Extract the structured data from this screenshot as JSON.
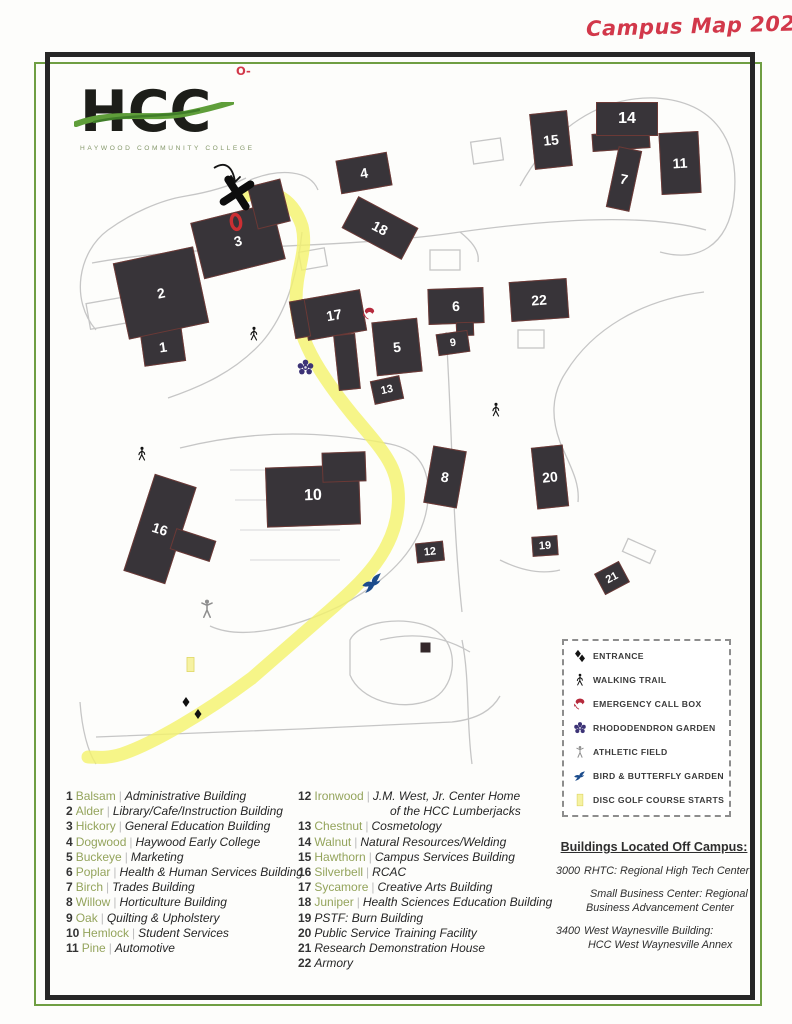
{
  "title": {
    "text": "Campus Map 2024"
  },
  "logo": {
    "acronym": "HCC",
    "subtitle": "HAYWOOD COMMUNITY COLLEGE"
  },
  "notes": {
    "top_bullet": "O-",
    "top_lines": [
      "Come up the ramp to the double",
      "exterior doors. Once you enter",
      "the building LSS is the",
      "first set of double",
      "doors to your",
      "right."
    ],
    "park_lines": [
      "Park",
      "here"
    ],
    "bottom_lines": [
      "* If you have any questions about",
      "how to get to LSS, please call us at",
      "(828) 627-4696"
    ]
  },
  "map": {
    "route_color": "#f4f36b",
    "buildings": [
      {
        "num": "1",
        "x": 142,
        "y": 330,
        "w": 42,
        "h": 34,
        "rot": -8
      },
      {
        "num": "2",
        "x": 120,
        "y": 254,
        "w": 82,
        "h": 78,
        "rot": -12
      },
      {
        "num": "3",
        "x": 196,
        "y": 212,
        "w": 84,
        "h": 58,
        "rot": -14
      },
      {
        "num": "",
        "x": 252,
        "y": 182,
        "w": 34,
        "h": 44,
        "rot": -14
      },
      {
        "num": "4",
        "x": 338,
        "y": 156,
        "w": 52,
        "h": 34,
        "rot": -10
      },
      {
        "num": "5",
        "x": 374,
        "y": 320,
        "w": 46,
        "h": 54,
        "rot": -6
      },
      {
        "num": "6",
        "x": 428,
        "y": 288,
        "w": 56,
        "h": 36,
        "rot": -2
      },
      {
        "num": "",
        "x": 456,
        "y": 322,
        "w": 18,
        "h": 14,
        "rot": -2
      },
      {
        "num": "",
        "x": 592,
        "y": 132,
        "w": 58,
        "h": 18,
        "rot": -4
      },
      {
        "num": "7",
        "x": 612,
        "y": 148,
        "w": 24,
        "h": 62,
        "rot": 12
      },
      {
        "num": "8",
        "x": 428,
        "y": 448,
        "w": 34,
        "h": 58,
        "rot": 10
      },
      {
        "num": "9",
        "x": 437,
        "y": 332,
        "w": 32,
        "h": 22,
        "rot": -8,
        "fs": 11
      },
      {
        "num": "10",
        "x": 266,
        "y": 466,
        "w": 94,
        "h": 60,
        "rot": -2,
        "fs": 16
      },
      {
        "num": "",
        "x": 322,
        "y": 452,
        "w": 44,
        "h": 30,
        "rot": -2
      },
      {
        "num": "11",
        "x": 660,
        "y": 132,
        "w": 40,
        "h": 62,
        "rot": -3
      },
      {
        "num": "12",
        "x": 416,
        "y": 542,
        "w": 28,
        "h": 20,
        "rot": -6,
        "fs": 11
      },
      {
        "num": "13",
        "x": 372,
        "y": 378,
        "w": 30,
        "h": 24,
        "rot": -12,
        "fs": 11
      },
      {
        "num": "14",
        "x": 596,
        "y": 102,
        "w": 62,
        "h": 34,
        "rot": 0,
        "fs": 16
      },
      {
        "num": "15",
        "x": 532,
        "y": 112,
        "w": 38,
        "h": 56,
        "rot": -6
      },
      {
        "num": "16",
        "x": 138,
        "y": 478,
        "w": 44,
        "h": 102,
        "rot": 18
      },
      {
        "num": "",
        "x": 172,
        "y": 534,
        "w": 42,
        "h": 22,
        "rot": 18
      },
      {
        "num": "17",
        "x": 304,
        "y": 294,
        "w": 60,
        "h": 42,
        "rot": -10
      },
      {
        "num": "",
        "x": 336,
        "y": 334,
        "w": 22,
        "h": 56,
        "rot": -6
      },
      {
        "num": "",
        "x": 292,
        "y": 300,
        "w": 16,
        "h": 38,
        "rot": -10
      },
      {
        "num": "18",
        "x": 346,
        "y": 210,
        "w": 68,
        "h": 36,
        "rot": 28
      },
      {
        "num": "19",
        "x": 532,
        "y": 536,
        "w": 26,
        "h": 20,
        "rot": -4,
        "fs": 11
      },
      {
        "num": "20",
        "x": 534,
        "y": 446,
        "w": 32,
        "h": 62,
        "rot": -6
      },
      {
        "num": "21",
        "x": 598,
        "y": 566,
        "w": 28,
        "h": 24,
        "rot": -28,
        "fs": 11
      },
      {
        "num": "22",
        "x": 510,
        "y": 280,
        "w": 58,
        "h": 40,
        "rot": -4
      }
    ],
    "road_labels": [
      {
        "t": "VOCATIONAL DR.",
        "x": 448,
        "y": 218,
        "rot": -8,
        "fs": 9,
        "ls": 1.2
      },
      {
        "t": "COLLEGE DR",
        "x": 253,
        "y": 318,
        "rot": -49,
        "fs": 9,
        "ls": 1
      },
      {
        "t": "SAWMILL DR.",
        "x": 432,
        "y": 592,
        "rot": -89,
        "fs": 9.5,
        "ls": 2
      },
      {
        "t": "RESEARCH HOUSE DR.",
        "x": 566,
        "y": 376,
        "rot": -32,
        "fs": 8,
        "ls": 1
      },
      {
        "t": "FREEDLANDER DR.",
        "x": 146,
        "y": 696,
        "rot": -28,
        "fs": 10,
        "ls": 1.2
      },
      {
        "t": "JONES COVE RD.",
        "x": 272,
        "y": 724,
        "rot": -1,
        "fs": 10,
        "ls": 1.2
      },
      {
        "t": "ARMORY DR.",
        "x": 452,
        "y": 760,
        "rot": -87,
        "fs": 9,
        "ls": 1.5
      },
      {
        "t": "HOSPITAL DR.",
        "x": 66,
        "y": 764,
        "rot": -72,
        "fs": 8.5,
        "ls": 0.8
      }
    ],
    "area_lines": [
      "MILLHOUSE",
      "&",
      "POND"
    ],
    "icons": [
      {
        "type": "x-mark",
        "x": 220,
        "y": 176,
        "s": 34,
        "rot": 12,
        "color": "#0d0d0d"
      },
      {
        "type": "red-oval",
        "x": 226,
        "y": 212,
        "s": 20,
        "rot": -10,
        "color": "#cc2f33"
      },
      {
        "type": "walking",
        "x": 246,
        "y": 326,
        "s": 16,
        "color": "#141414"
      },
      {
        "type": "walking",
        "x": 488,
        "y": 402,
        "s": 16,
        "color": "#141414"
      },
      {
        "type": "walking",
        "x": 134,
        "y": 446,
        "s": 16,
        "color": "#141414"
      },
      {
        "type": "athletic",
        "x": 196,
        "y": 598,
        "s": 22,
        "color": "#8f8f8f"
      },
      {
        "type": "callbox",
        "x": 362,
        "y": 306,
        "s": 15,
        "color": "#b52a3c"
      },
      {
        "type": "rhododendron",
        "x": 296,
        "y": 358,
        "s": 19,
        "color": "#3c3376"
      },
      {
        "type": "bird",
        "x": 360,
        "y": 570,
        "s": 26,
        "rot": -8,
        "color": "#1c4c8c"
      },
      {
        "type": "entrance-diamond",
        "x": 180,
        "y": 696,
        "s": 12,
        "color": "#101010"
      },
      {
        "type": "entrance-diamond",
        "x": 192,
        "y": 708,
        "s": 12,
        "color": "#101010"
      },
      {
        "type": "disc-golf",
        "x": 182,
        "y": 656,
        "s": 17
      },
      {
        "type": "millhouse",
        "x": 418,
        "y": 640,
        "s": 15,
        "color": "#33272a"
      }
    ]
  },
  "legend": {
    "items": [
      {
        "icon": "entrance",
        "label": "ENTRANCE",
        "color": "#141414"
      },
      {
        "icon": "walking",
        "label": "WALKING TRAIL",
        "color": "#141414"
      },
      {
        "icon": "callbox",
        "label": "EMERGENCY CALL BOX",
        "color": "#b52a3c"
      },
      {
        "icon": "rhododendron",
        "label": "RHODODENDRON GARDEN",
        "color": "#3c3376"
      },
      {
        "icon": "athletic",
        "label": "ATHLETIC FIELD",
        "color": "#8f8f8f"
      },
      {
        "icon": "bird",
        "label": "BIRD & BUTTERFLY GARDEN",
        "color": "#1c4c8c"
      },
      {
        "icon": "disc-golf",
        "label": "DISC GOLF COURSE STARTS",
        "color": "#e8e070"
      }
    ]
  },
  "list": {
    "left": [
      {
        "num": "1",
        "name": "Balsam",
        "sep": "|",
        "desc": "Administrative Building"
      },
      {
        "num": "2",
        "name": "Alder",
        "sep": "|",
        "desc": "Library/Cafe/Instruction Building"
      },
      {
        "num": "3",
        "name": "Hickory",
        "sep": "|",
        "desc": "General Education Building"
      },
      {
        "num": "4",
        "name": "Dogwood",
        "sep": "|",
        "desc": "Haywood Early College"
      },
      {
        "num": "5",
        "name": "Buckeye",
        "sep": "|",
        "desc": "Marketing"
      },
      {
        "num": "6",
        "name": "Poplar",
        "sep": "|",
        "desc": "Health & Human Services Building"
      },
      {
        "num": "7",
        "name": "Birch",
        "sep": "|",
        "desc": "Trades Building"
      },
      {
        "num": "8",
        "name": "Willow",
        "sep": "|",
        "desc": "Horticulture Building"
      },
      {
        "num": "9",
        "name": "Oak",
        "sep": "|",
        "desc": "Quilting & Upholstery"
      },
      {
        "num": "10",
        "name": "Hemlock",
        "sep": "|",
        "desc": "Student Services"
      },
      {
        "num": "11",
        "name": "Pine",
        "sep": "|",
        "desc": "Automotive"
      }
    ],
    "right": [
      {
        "num": "12",
        "name": "Ironwood",
        "sep": "|",
        "desc": "J.M. West, Jr. Center Home",
        "desc2": "of the HCC Lumberjacks"
      },
      {
        "num": "13",
        "name": "Chestnut",
        "sep": "|",
        "desc": "Cosmetology"
      },
      {
        "num": "14",
        "name": "Walnut",
        "sep": "|",
        "desc": "Natural Resources/Welding"
      },
      {
        "num": "15",
        "name": "Hawthorn",
        "sep": "|",
        "desc": "Campus Services Building"
      },
      {
        "num": "16",
        "name": "Silverbell",
        "sep": "|",
        "desc": "RCAC"
      },
      {
        "num": "17",
        "name": "Sycamore",
        "sep": "|",
        "desc": "Creative Arts Building"
      },
      {
        "num": "18",
        "name": "Juniper",
        "sep": "|",
        "desc": "Health Sciences Education Building"
      },
      {
        "num": "19",
        "name": "",
        "sep": "",
        "desc": "PSTF: Burn Building"
      },
      {
        "num": "20",
        "name": "",
        "sep": "",
        "desc": "Public Service Training Facility"
      },
      {
        "num": "21",
        "name": "",
        "sep": "",
        "desc": "Research Demonstration House"
      },
      {
        "num": "22",
        "name": "",
        "sep": "",
        "desc": "Armory"
      }
    ]
  },
  "off_campus": {
    "title": "Buildings Located Off Campus:",
    "entries": [
      {
        "num": "3000",
        "text": "RHTC: Regional High Tech Center",
        "text2": ""
      },
      {
        "num": "",
        "text": "Small Business Center: Regional",
        "text2": "Business Advancement Center",
        "cls": "indent"
      },
      {
        "num": "3400",
        "text": "West Waynesville Building:",
        "text2": "HCC West Waynesville Annex",
        "cls": "hang"
      }
    ]
  }
}
